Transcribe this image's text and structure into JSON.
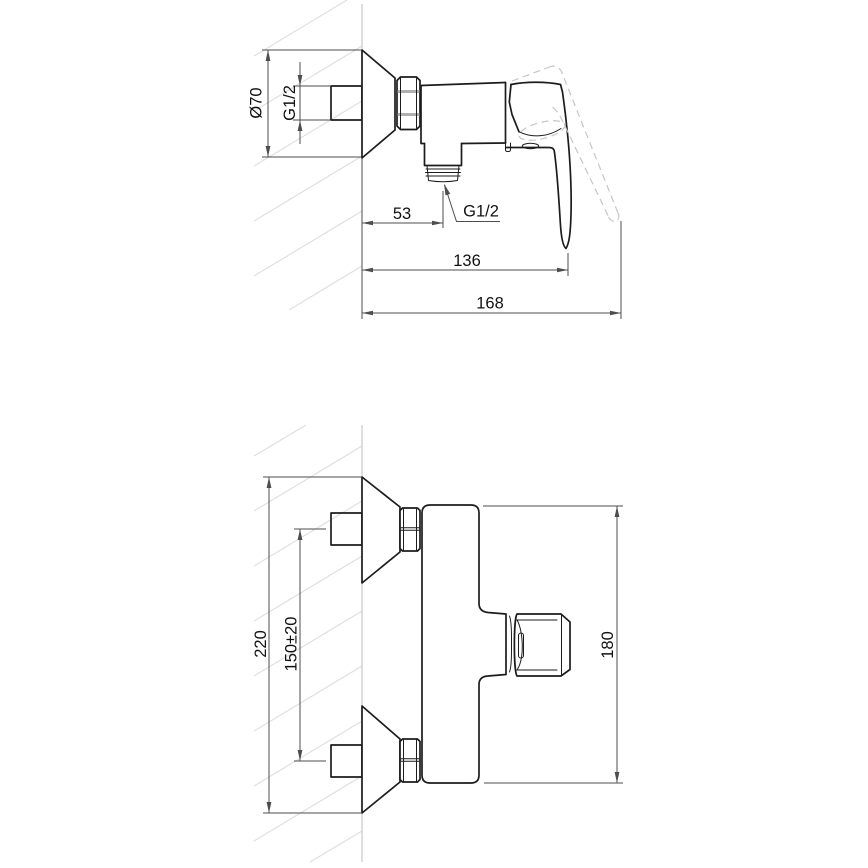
{
  "document": {
    "type": "technical-dimension-drawing",
    "subject": "wall-mounted single-lever shower mixer, two orthographic views",
    "background": "#ffffff"
  },
  "colors": {
    "outline": "#1c1c1c",
    "dimension": "#4d4d4d",
    "wall": "#c9c9c9",
    "hatch": "#dedede",
    "phantom": "#c6c6c6",
    "text": "#111111"
  },
  "views": {
    "side_view": {
      "title": "side view (handle shown in lowered and raised position)",
      "dimensions": {
        "escutcheon_diameter": "Ø70",
        "inlet_thread": "G1/2",
        "wall_to_outlet": "53",
        "outlet_thread": "G1/2",
        "wall_to_lever_tip": "136",
        "max_depth": "168"
      }
    },
    "plan_view": {
      "title": "plan view",
      "dimensions": {
        "overall_span": "220",
        "inlet_centres": "150±20",
        "body_span": "180"
      }
    }
  }
}
